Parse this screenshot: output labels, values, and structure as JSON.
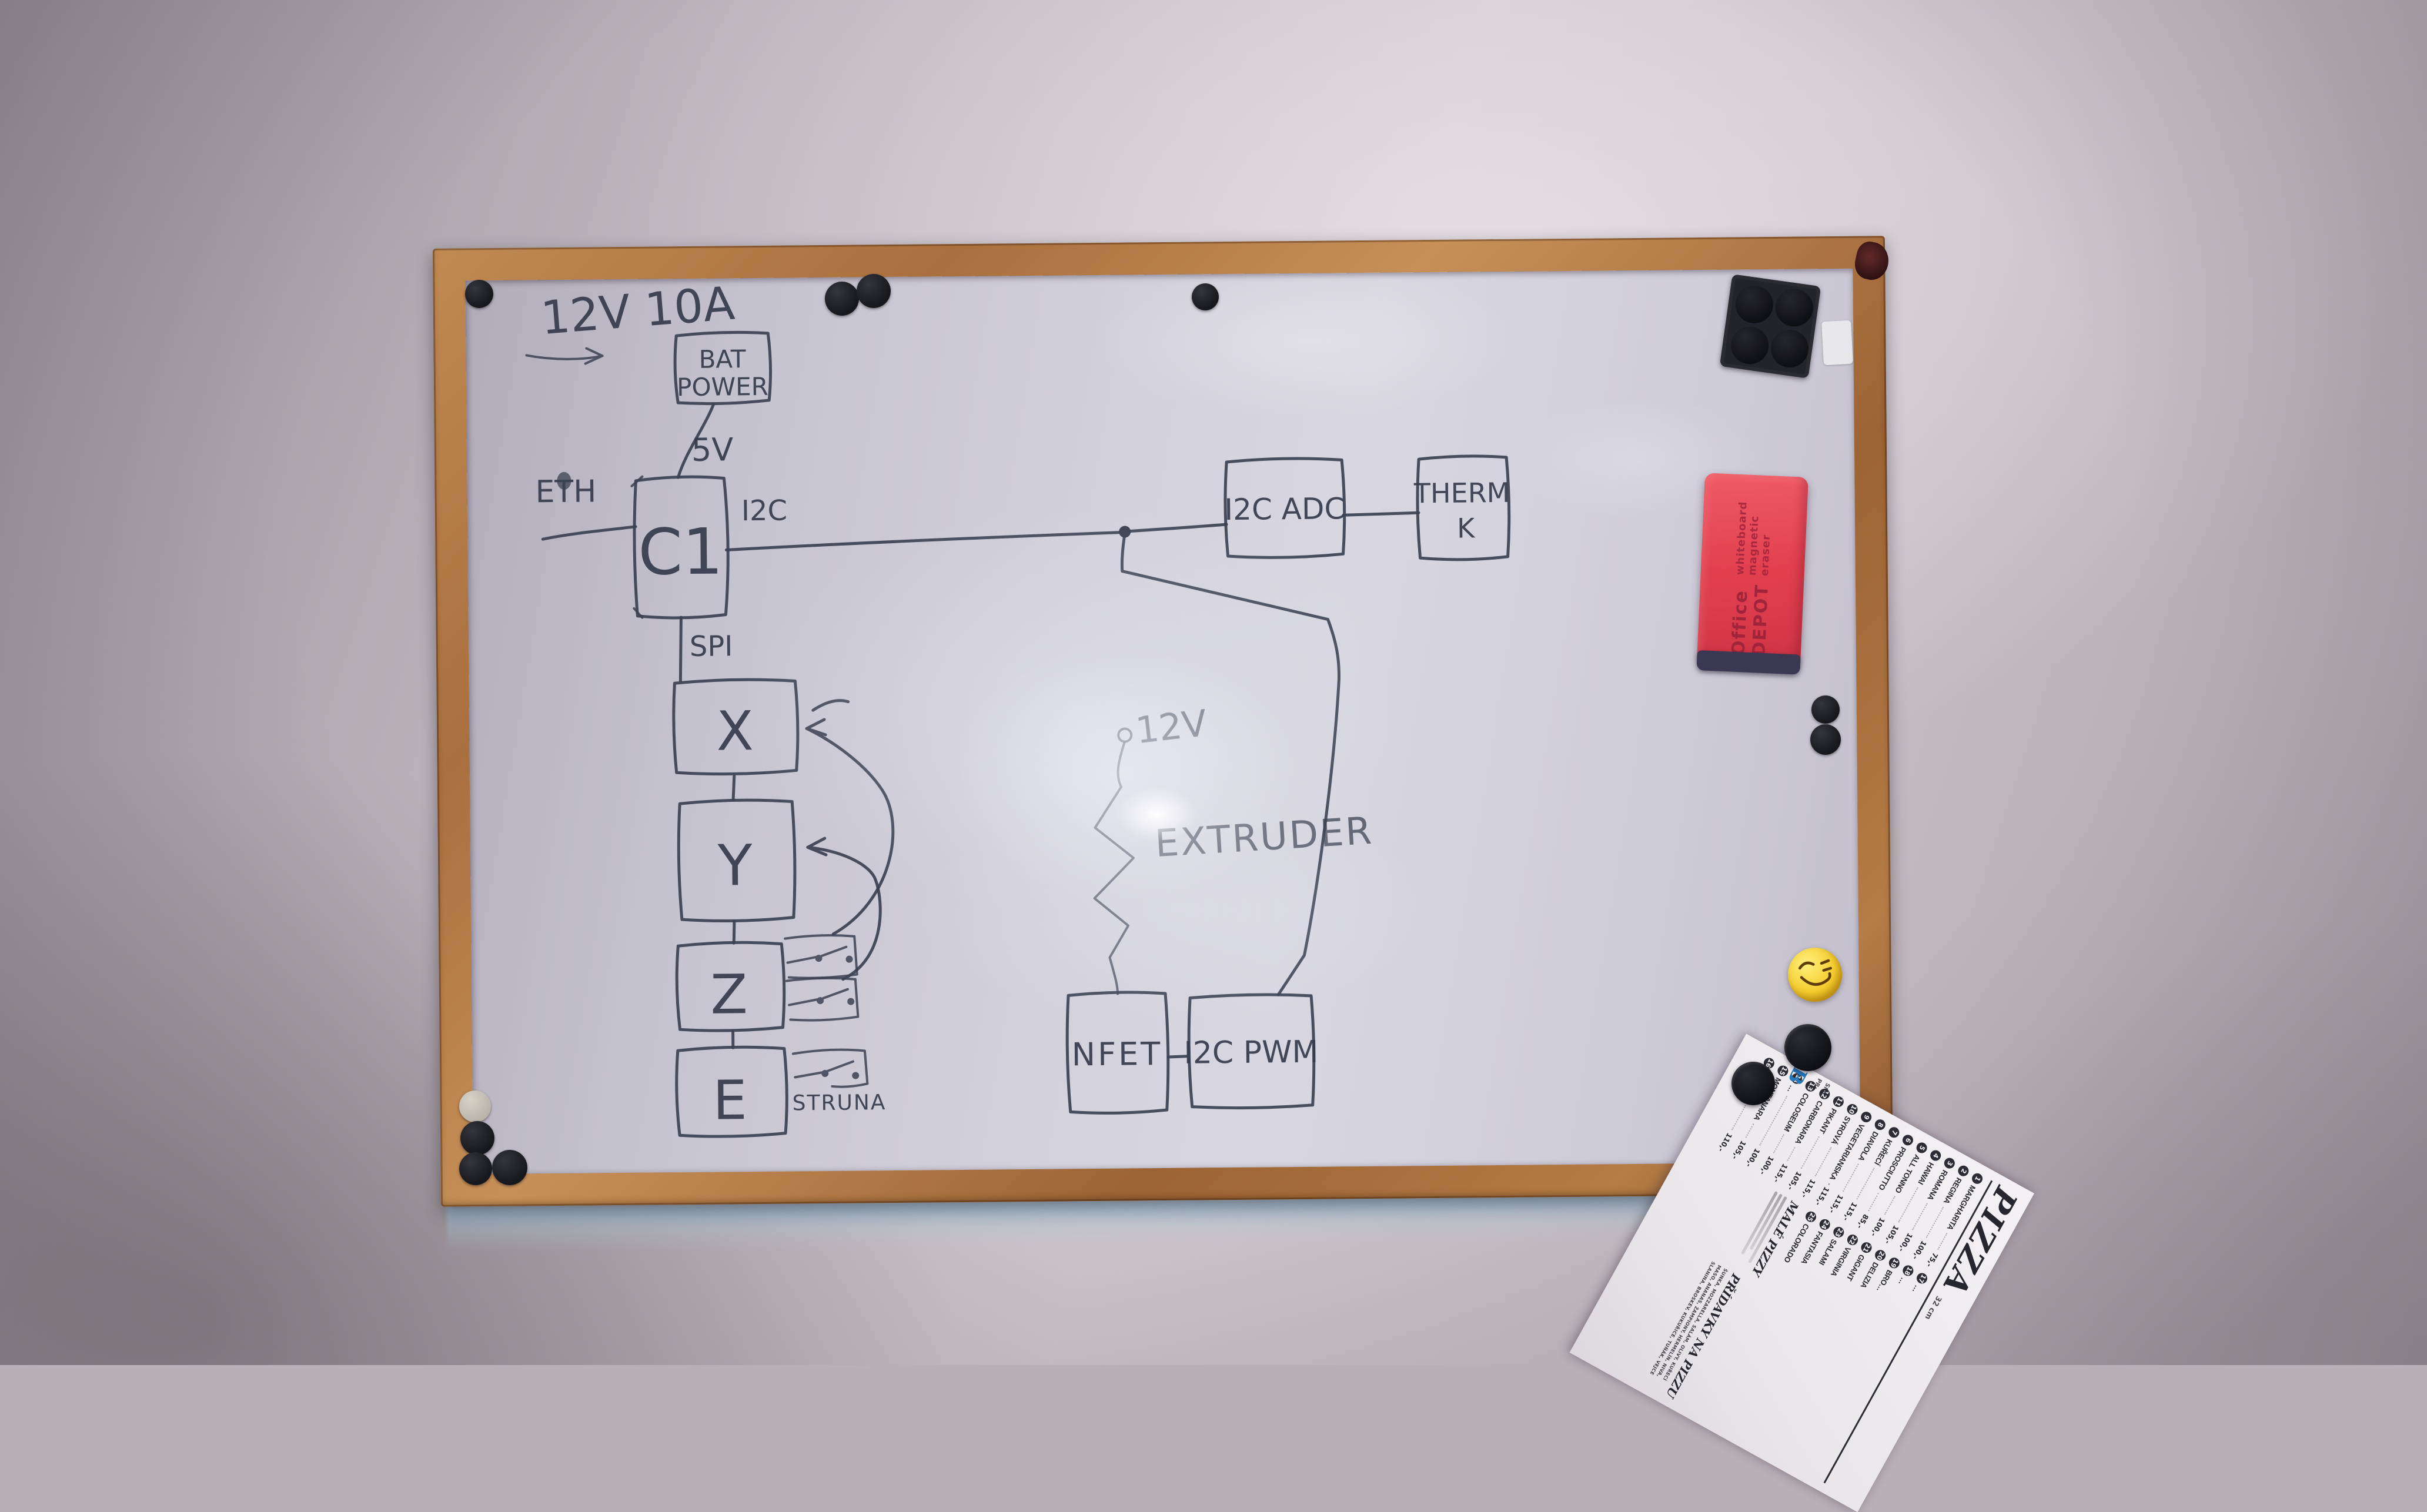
{
  "colors": {
    "ink": "#3c4152",
    "eraser_red": "#e2404f",
    "smiley_yellow": "#f5cd2e",
    "menu_brand_blue": "#2477b8",
    "frame_wood": "#a96f3e"
  },
  "diagram": {
    "power_label": "12V 10A",
    "nodes": {
      "bat": {
        "line1": "BAT",
        "line2": "POWER"
      },
      "c1": "C1",
      "adc": "I2C ADC",
      "therm": {
        "line1": "THERM",
        "line2": "K"
      },
      "x": "X",
      "y": "Y",
      "z": "Z",
      "e": "E",
      "nfet": "NFET",
      "pwm": "I2C PWM"
    },
    "labels": {
      "v5": "5V",
      "eth": "ETH",
      "i2c": "I2C",
      "spi": "SPI",
      "v12": "12V",
      "extruder": "EXTRUDER",
      "struna": "STRUNA"
    }
  },
  "eraser": {
    "brand": "Office DEPOT",
    "sub": "whiteboard magnetic eraser"
  },
  "menu": {
    "title": "PIZZA",
    "size_note": "32 cm",
    "badge": "B",
    "margin_label1": "SM,",
    "margin_label2": "PR:",
    "items": [
      {
        "n": "1",
        "name": "MARGHARITA",
        "price": "75,-"
      },
      {
        "n": "2",
        "name": "REGINA",
        "price": "100,-"
      },
      {
        "n": "3",
        "name": "ROMANA",
        "price": "100,-"
      },
      {
        "n": "4",
        "name": "HAWAI",
        "price": "105,-"
      },
      {
        "n": "5",
        "name": "ALL TONNO",
        "price": "100,-"
      },
      {
        "n": "6",
        "name": "PROSCIUTTO",
        "price": "85,-"
      },
      {
        "n": "7",
        "name": "KUŘECÍ",
        "price": "115,-"
      },
      {
        "n": "8",
        "name": "DIAVOLA",
        "price": "115,-"
      },
      {
        "n": "9",
        "name": "VEGETARIANSKA",
        "price": "115,-"
      },
      {
        "n": "10",
        "name": "SYROVÁ",
        "price": "115,-"
      },
      {
        "n": "11",
        "name": "PIKANT",
        "price": "105,-"
      },
      {
        "n": "12",
        "name": "CARBONARA",
        "price": "115,-"
      },
      {
        "n": "13",
        "name": "COLOSEUM",
        "price": "100,-"
      },
      {
        "n": "14",
        "name": "…",
        "price": "100,-"
      },
      {
        "n": "15",
        "name": "MONTANARA",
        "price": "105,-"
      },
      {
        "n": "16",
        "name": "VEPŘOVÁ",
        "price": "110,-"
      }
    ],
    "items2": [
      {
        "n": "17",
        "name": "…"
      },
      {
        "n": "18",
        "name": "…"
      },
      {
        "n": "19",
        "name": "BRO…"
      },
      {
        "n": "20",
        "name": "DELIZIA"
      },
      {
        "n": "21",
        "name": "GIGANT"
      },
      {
        "n": "22",
        "name": "VIRGINIA"
      },
      {
        "n": "23",
        "name": "SALAMI"
      },
      {
        "n": "24",
        "name": "FANTASIA"
      },
      {
        "n": "25",
        "name": "COLORADO"
      }
    ],
    "section_small": "MALÉ PIZZY",
    "section_extras": "PŘÍDAVKY NA PIZZU",
    "toppings": "ŠUNKA, MOZZARELLA, SALÁM, OLIVY, KUŘECÍ MASO, ANANAS, ŽAMPIONY, HERMELÍN, NIVA, SLANINA, BROSKEV, KUKUŘICE, TUŇÁK, VEJCE"
  }
}
